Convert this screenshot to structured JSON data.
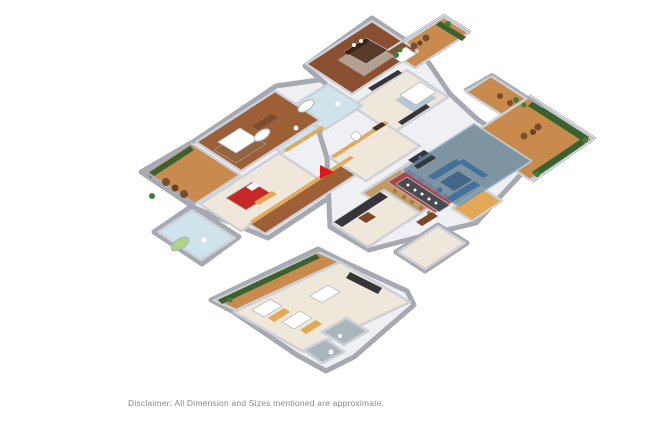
{
  "disclaimer": "Disclaimer: All Dimension and Sizes mentioned are approximate.",
  "floorplan": {
    "type": "3d-isometric-floor-plan",
    "highlighted_room": "living-room",
    "rooms": [
      "master-bedroom",
      "bedroom-2",
      "bedroom-3",
      "bedroom-4",
      "living-room",
      "dining-room",
      "kitchen",
      "foyer",
      "corridor",
      "bathroom-master",
      "bathroom-2",
      "bathroom-3",
      "servant-rooms",
      "utility-bath",
      "balcony-left",
      "terrace-top",
      "deck-right",
      "balcony-bottom"
    ],
    "icons": [
      "entrance-arrow"
    ]
  },
  "palette": {
    "mass": "#eef0f3",
    "cream": "#efe8da",
    "woodDark": "#8a4f2e",
    "woodMid": "#9c5f36",
    "woodLight": "#c29a64",
    "woodDeck": "#c98a4e",
    "tileBlue": "#cfe3ea",
    "tileGrey": "#a9b7bd",
    "tubGreen": "#aed387",
    "highlightBlue": "#6493b8",
    "sofaBlue": "#44719b",
    "rugBlueDark": "#2e5a80",
    "rugBlue": "#9db8d8",
    "rugRed": "#a03040",
    "rugBrown": "#8a6a4a",
    "rugGrey": "#cfd6d2",
    "bedRed": "#c62828",
    "bedBrown": "#5a3a28",
    "headboard": "#3a2418",
    "tableDark": "#4a4a50",
    "counterDark": "#35353a",
    "cabinetBrown": "#4a3020",
    "sideboardBrown": "#7a4a28",
    "wardrobeTan": "#e2a855",
    "wicker": "#7a4e2c",
    "wickerTable": "#6b4226",
    "hedge": "#39622e",
    "plant": "#3f7d3a",
    "white": "#ffffff",
    "chairTan": "#a5794a",
    "arrowRed": "#e01818"
  }
}
